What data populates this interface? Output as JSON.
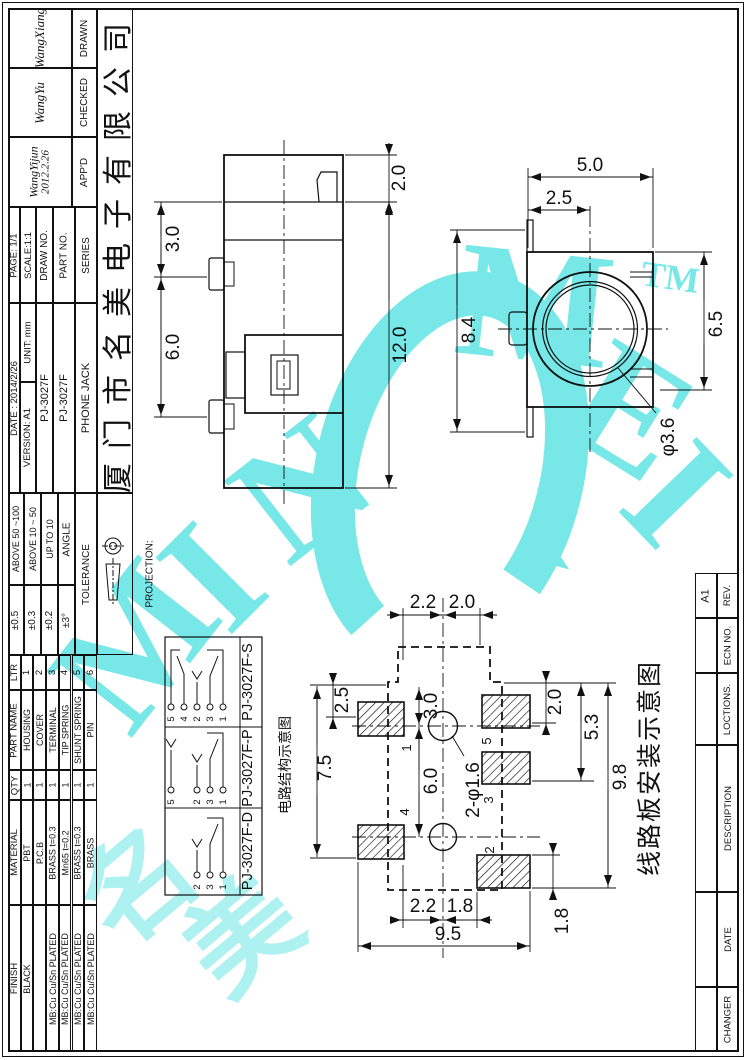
{
  "company": "厦门市名美电子有限公司",
  "approval": {
    "drawn_label": "DRAWN",
    "drawn_sig": "WangXiang",
    "checked_label": "CHECKED",
    "checked_sig": "WangYu",
    "appd_label": "APP'D",
    "appd_sig": "WangYijun",
    "appd_date": "2012.2.26"
  },
  "info": {
    "series_label": "SERIES",
    "series_value": "PHONE JACK",
    "part_label": "PART NO.",
    "part_value": "PJ-3027F",
    "draw_label": "DRAW NO.",
    "draw_value": "PJ-3027F",
    "scale": "SCALE:1:1",
    "unit": "UNIT: mm",
    "version": "VERSION: A1",
    "page": "PAGE: 1/1",
    "date": "DATE : 2014/2/26"
  },
  "tolerance": {
    "header": "TOLERANCE",
    "projection": "PROJECTION:",
    "rows": [
      {
        "range": "ABOVE 50 ~100",
        "value": "±0.5"
      },
      {
        "range": "ABOVE 10 ~ 50",
        "value": "±0.3"
      },
      {
        "range": "UP TO 10",
        "value": "±0.2"
      },
      {
        "range": "ANGLE",
        "value": "±3°"
      }
    ]
  },
  "bom": {
    "ltr": "LTR",
    "part_name": "PART NAME",
    "qty": "QTY",
    "material": "MATERIAL",
    "finish": "FINISH",
    "rows": [
      {
        "ltr": "1",
        "name": "HOUSING",
        "qty": "1",
        "mat": "PBT",
        "fin": "BLACK"
      },
      {
        "ltr": "2",
        "name": "COVER",
        "qty": "1",
        "mat": "P.C.B",
        "fin": ""
      },
      {
        "ltr": "3",
        "name": "TERMINAL",
        "qty": "1",
        "mat": "BRASS t=0.3",
        "fin": "MB:Cu Cu/Sn PLATED"
      },
      {
        "ltr": "4",
        "name": "TIP SPRING",
        "qty": "1",
        "mat": "Mn65 t=0.2",
        "fin": "MB:Cu Cu/Sn PLATED"
      },
      {
        "ltr": "5",
        "name": "SHUNT SPRING",
        "qty": "1",
        "mat": "BRASS t=0.3",
        "fin": "MB:Cu Cu/Sn PLATED"
      },
      {
        "ltr": "6",
        "name": "PIN",
        "qty": "1",
        "mat": "BRASS",
        "fin": "MB:Cu Cu/Sn PLATED"
      }
    ]
  },
  "revision": {
    "rows": [
      {
        "label": "REV.",
        "value": "A1"
      },
      {
        "label": "ECN NO.",
        "value": ""
      },
      {
        "label": "LOCTIONS.",
        "value": ""
      },
      {
        "label": "DESCRIPTION",
        "value": ""
      },
      {
        "label": "DATE",
        "value": ""
      },
      {
        "label": "CHANGER",
        "value": ""
      }
    ]
  },
  "schematics": {
    "caption": "电路结构示意图",
    "cells": [
      {
        "label": "PJ-3027F-S",
        "pins": [
          "5",
          "4",
          "2",
          "3",
          "1"
        ]
      },
      {
        "label": "PJ-3027F-P",
        "pins": [
          "5",
          "2",
          "3",
          "1"
        ]
      },
      {
        "label": "PJ-3027F-D",
        "pins": [
          "2",
          "3",
          "1"
        ]
      }
    ]
  },
  "views": {
    "side": {
      "d2": "2.0",
      "d3": "3.0",
      "d6": "6.0",
      "d12": "12.0"
    },
    "front": {
      "d5": "5.0",
      "d25": "2.5",
      "d84": "8.4",
      "d65": "6.5",
      "dia": "φ3.6"
    },
    "pcb": {
      "caption": "线路板安装示意图",
      "t22": "2.2",
      "t20": "2.0",
      "l25": "2.5",
      "l75": "7.5",
      "c30": "3.0",
      "c60": "6.0",
      "holes": "2-φ1.6",
      "r20": "2.0",
      "r53": "5.3",
      "r98": "9.8",
      "b22": "2.2",
      "b18": "1.8",
      "b95": "9.5",
      "br18": "1.8",
      "pads": {
        "p1": "1",
        "p4": "4",
        "p5": "5",
        "p3": "3",
        "p2": "2"
      }
    }
  },
  "watermark": {
    "m1": "M",
    "i1": "I",
    "n1": "N",
    "m2": "M",
    "e": "E",
    "i2": "I",
    "tm": "TM",
    "cjk1": "名",
    "cjk2": "美",
    "color": "#55e1e1"
  }
}
